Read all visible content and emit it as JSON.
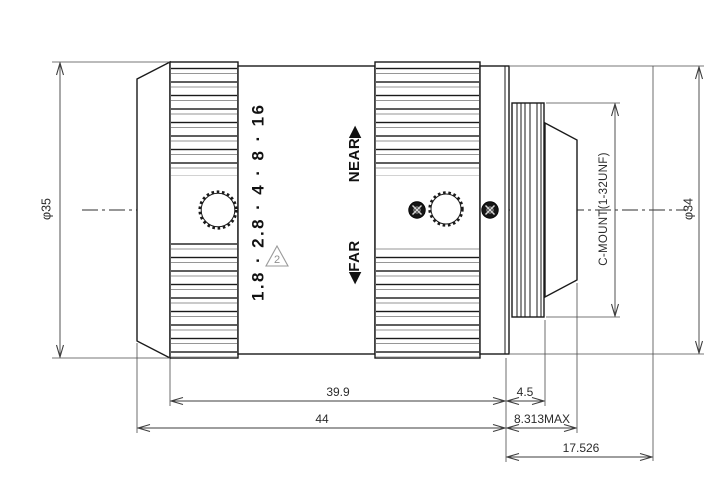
{
  "annotations": {
    "aperture_scale": "1.8 · 2.8 · 4 · 8 · 16",
    "near_label": "NEAR▶",
    "far_label": "◀FAR",
    "revision_flag": "2",
    "mount_spec": "C-MOUNT(1-32UNF)"
  },
  "dimensions": {
    "front_diameter": "φ35",
    "rear_diameter": "φ34",
    "barrel_length": "39.9",
    "overall_length": "44",
    "thread_length": "4.5",
    "rear_protrusion_max": "8.313MAX",
    "flange_focal_distance": "17.526"
  },
  "colors": {
    "outline": "#1a1a1a",
    "dimension": "#3d3d3d",
    "accent_gray": "#8f8f8f",
    "background": "#ffffff"
  }
}
